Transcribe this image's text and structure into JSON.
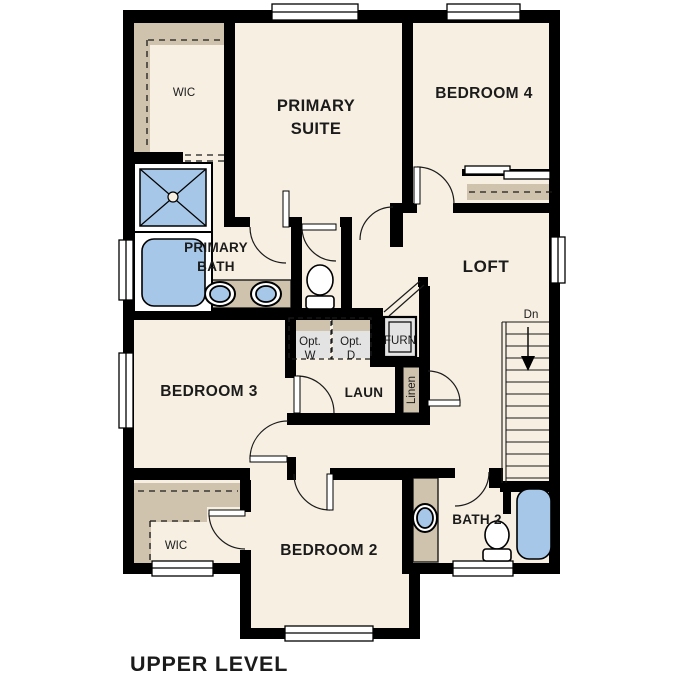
{
  "plan_title": "UPPER LEVEL",
  "colors": {
    "background": "#ffffff",
    "floor": "#f6efe2",
    "wall": "#000000",
    "shelf": "#cfc3ad",
    "fixture_blue": "#a6c7e8",
    "appliance_gray": "#e3e3e3",
    "text": "#1b1b1b"
  },
  "rooms": {
    "wic_primary": {
      "label": "WIC"
    },
    "primary_suite": {
      "line1": "PRIMARY",
      "line2": "SUITE"
    },
    "bedroom4": {
      "label": "BEDROOM 4"
    },
    "primary_bath": {
      "line1": "PRIMARY",
      "line2": "BATH"
    },
    "loft": {
      "label": "LOFT"
    },
    "bedroom3": {
      "label": "BEDROOM 3"
    },
    "laundry": {
      "label": "LAUN"
    },
    "furnace": {
      "label": "FURN"
    },
    "linen": {
      "label": "Linen"
    },
    "bedroom2": {
      "label": "BEDROOM 2"
    },
    "bath2": {
      "label": "BATH 2"
    },
    "wic_bedroom2": {
      "label": "WIC"
    }
  },
  "appliances": {
    "opt_washer": {
      "line1": "Opt.",
      "line2": "W"
    },
    "opt_dryer": {
      "line1": "Opt.",
      "line2": "D"
    }
  },
  "stairs": {
    "direction_label": "Dn"
  }
}
